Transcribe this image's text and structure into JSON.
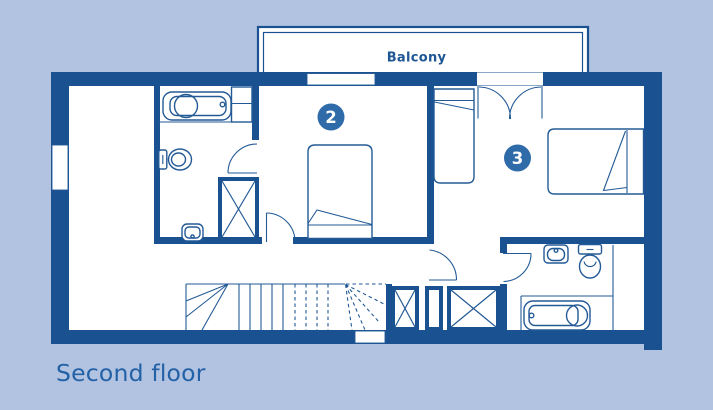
{
  "page": {
    "background_color": "#b2c2e1"
  },
  "plan": {
    "floor_label": "Second floor",
    "balcony_label": "Balcony",
    "rooms": [
      {
        "number": "2"
      },
      {
        "number": "3"
      }
    ],
    "colors": {
      "wall": "#1a5190",
      "line": "#235a96",
      "room_badge": "#2e6ba8",
      "badge_text": "#ffffff",
      "floor": "#ffffff",
      "label_text": "#2361a6"
    },
    "fixture_icons": [
      "bathtub-icon",
      "toilet-icon",
      "sink-icon",
      "wardrobe-x-icon",
      "double-bed-icon",
      "single-bed-icon",
      "stairs-icon",
      "door-swing-icon",
      "double-door-swing-icon",
      "window-icon"
    ]
  }
}
